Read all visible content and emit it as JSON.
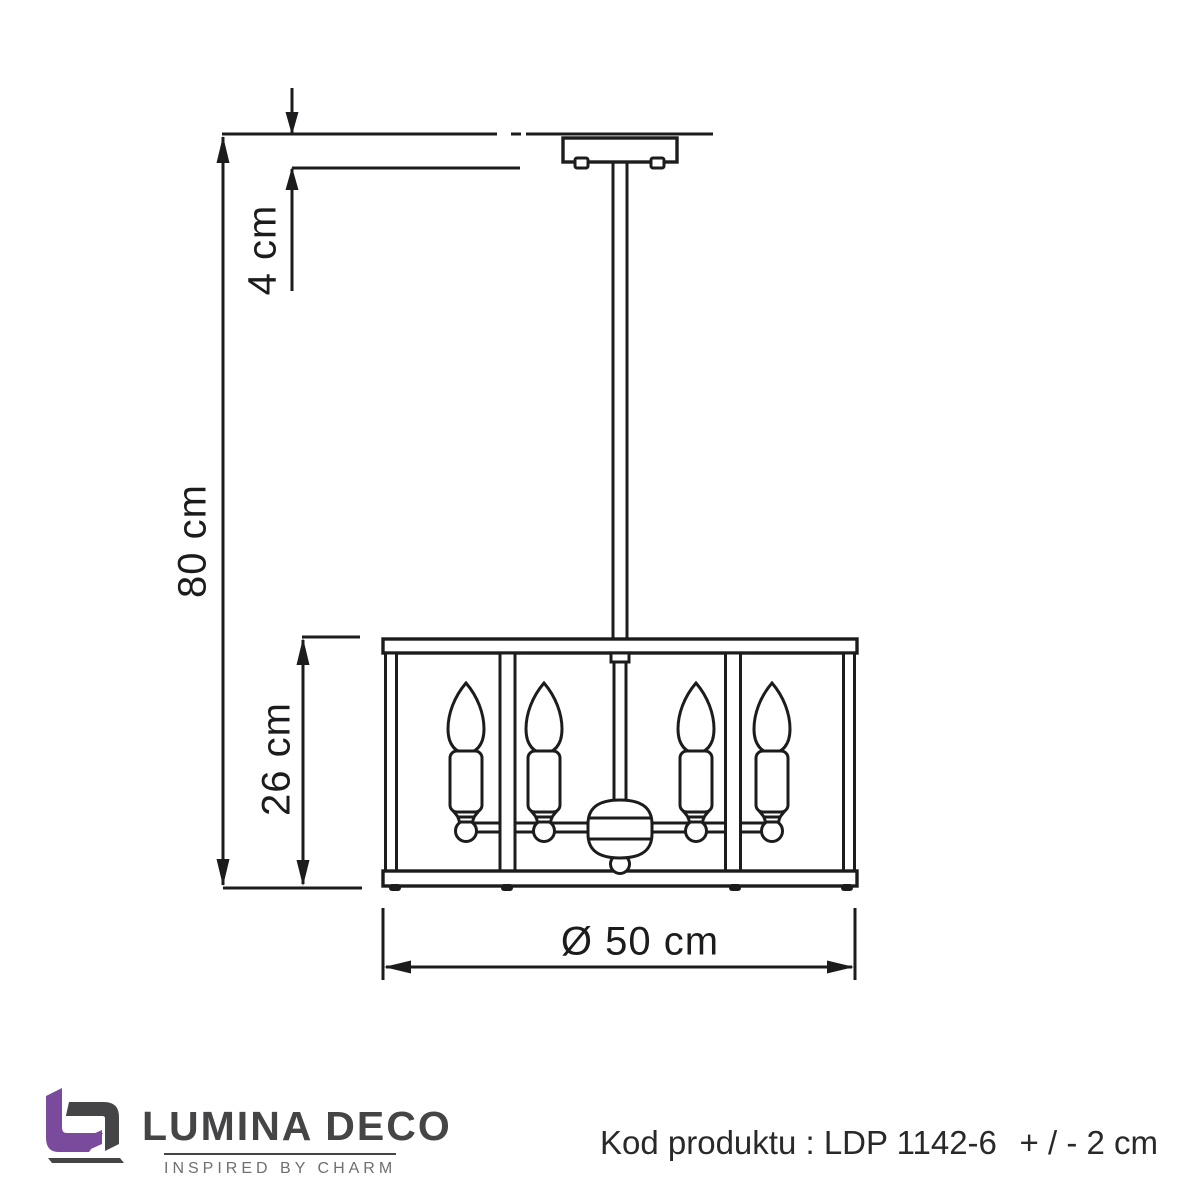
{
  "brand": {
    "name": "LUMINA DECO",
    "tagline": "INSPIRED BY CHARM"
  },
  "product": {
    "code_label": "Kod produktu : LDP 1142-6",
    "tolerance": "+ / - 2 cm"
  },
  "dimensions": {
    "canopy_height": "4 cm",
    "total_height": "80 cm",
    "shade_height": "26 cm",
    "diameter": "Ø 50 cm"
  },
  "drawing": {
    "type": "technical-dimension-drawing",
    "subject": "pendant lamp with square cage shade",
    "bulb_count": 4
  },
  "colors": {
    "line": "#1c1c1e",
    "brand_purple": "#7a4b9c",
    "brand_dark": "#454547",
    "brand_gray": "#6f6f71",
    "text": "#29292b"
  }
}
